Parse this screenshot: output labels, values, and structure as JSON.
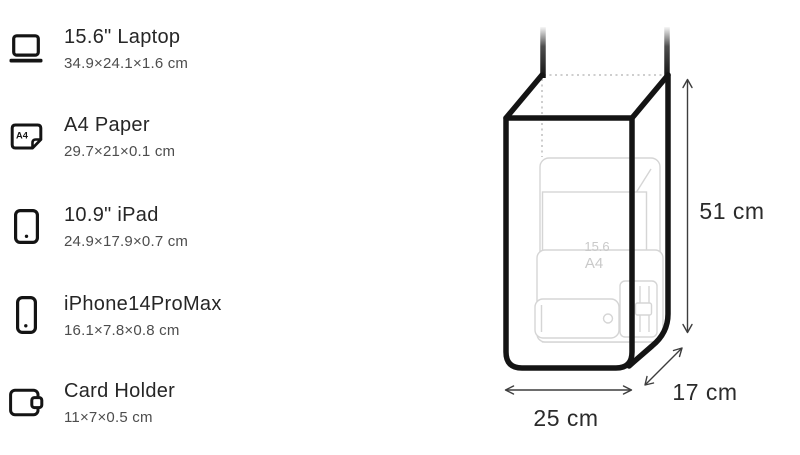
{
  "items": [
    {
      "name": "15.6\" Laptop",
      "dimensions": "34.9×24.1×1.6 cm"
    },
    {
      "name": "A4 Paper",
      "dimensions": "29.7×21×0.1 cm"
    },
    {
      "name": "10.9\" iPad",
      "dimensions": "24.9×17.9×0.7 cm"
    },
    {
      "name": "iPhone14ProMax",
      "dimensions": "16.1×7.8×0.8 cm"
    },
    {
      "name": "Card Holder",
      "dimensions": "11×7×0.5 cm"
    }
  ],
  "icons": {
    "a4_badge": "A4"
  },
  "diagram": {
    "height_label": "51 cm",
    "width_label": "25 cm",
    "depth_label": "17 cm",
    "inner_labels": {
      "laptop_diagonal": "15.6",
      "a4_sheet": "A4"
    },
    "colors": {
      "outline": "#141414",
      "faint_item_stroke": "#d5d5d5",
      "dotted_edge": "#bdbdbd",
      "dimension_line": "#3d3d3d",
      "dimension_text": "#2b2b2b"
    }
  }
}
